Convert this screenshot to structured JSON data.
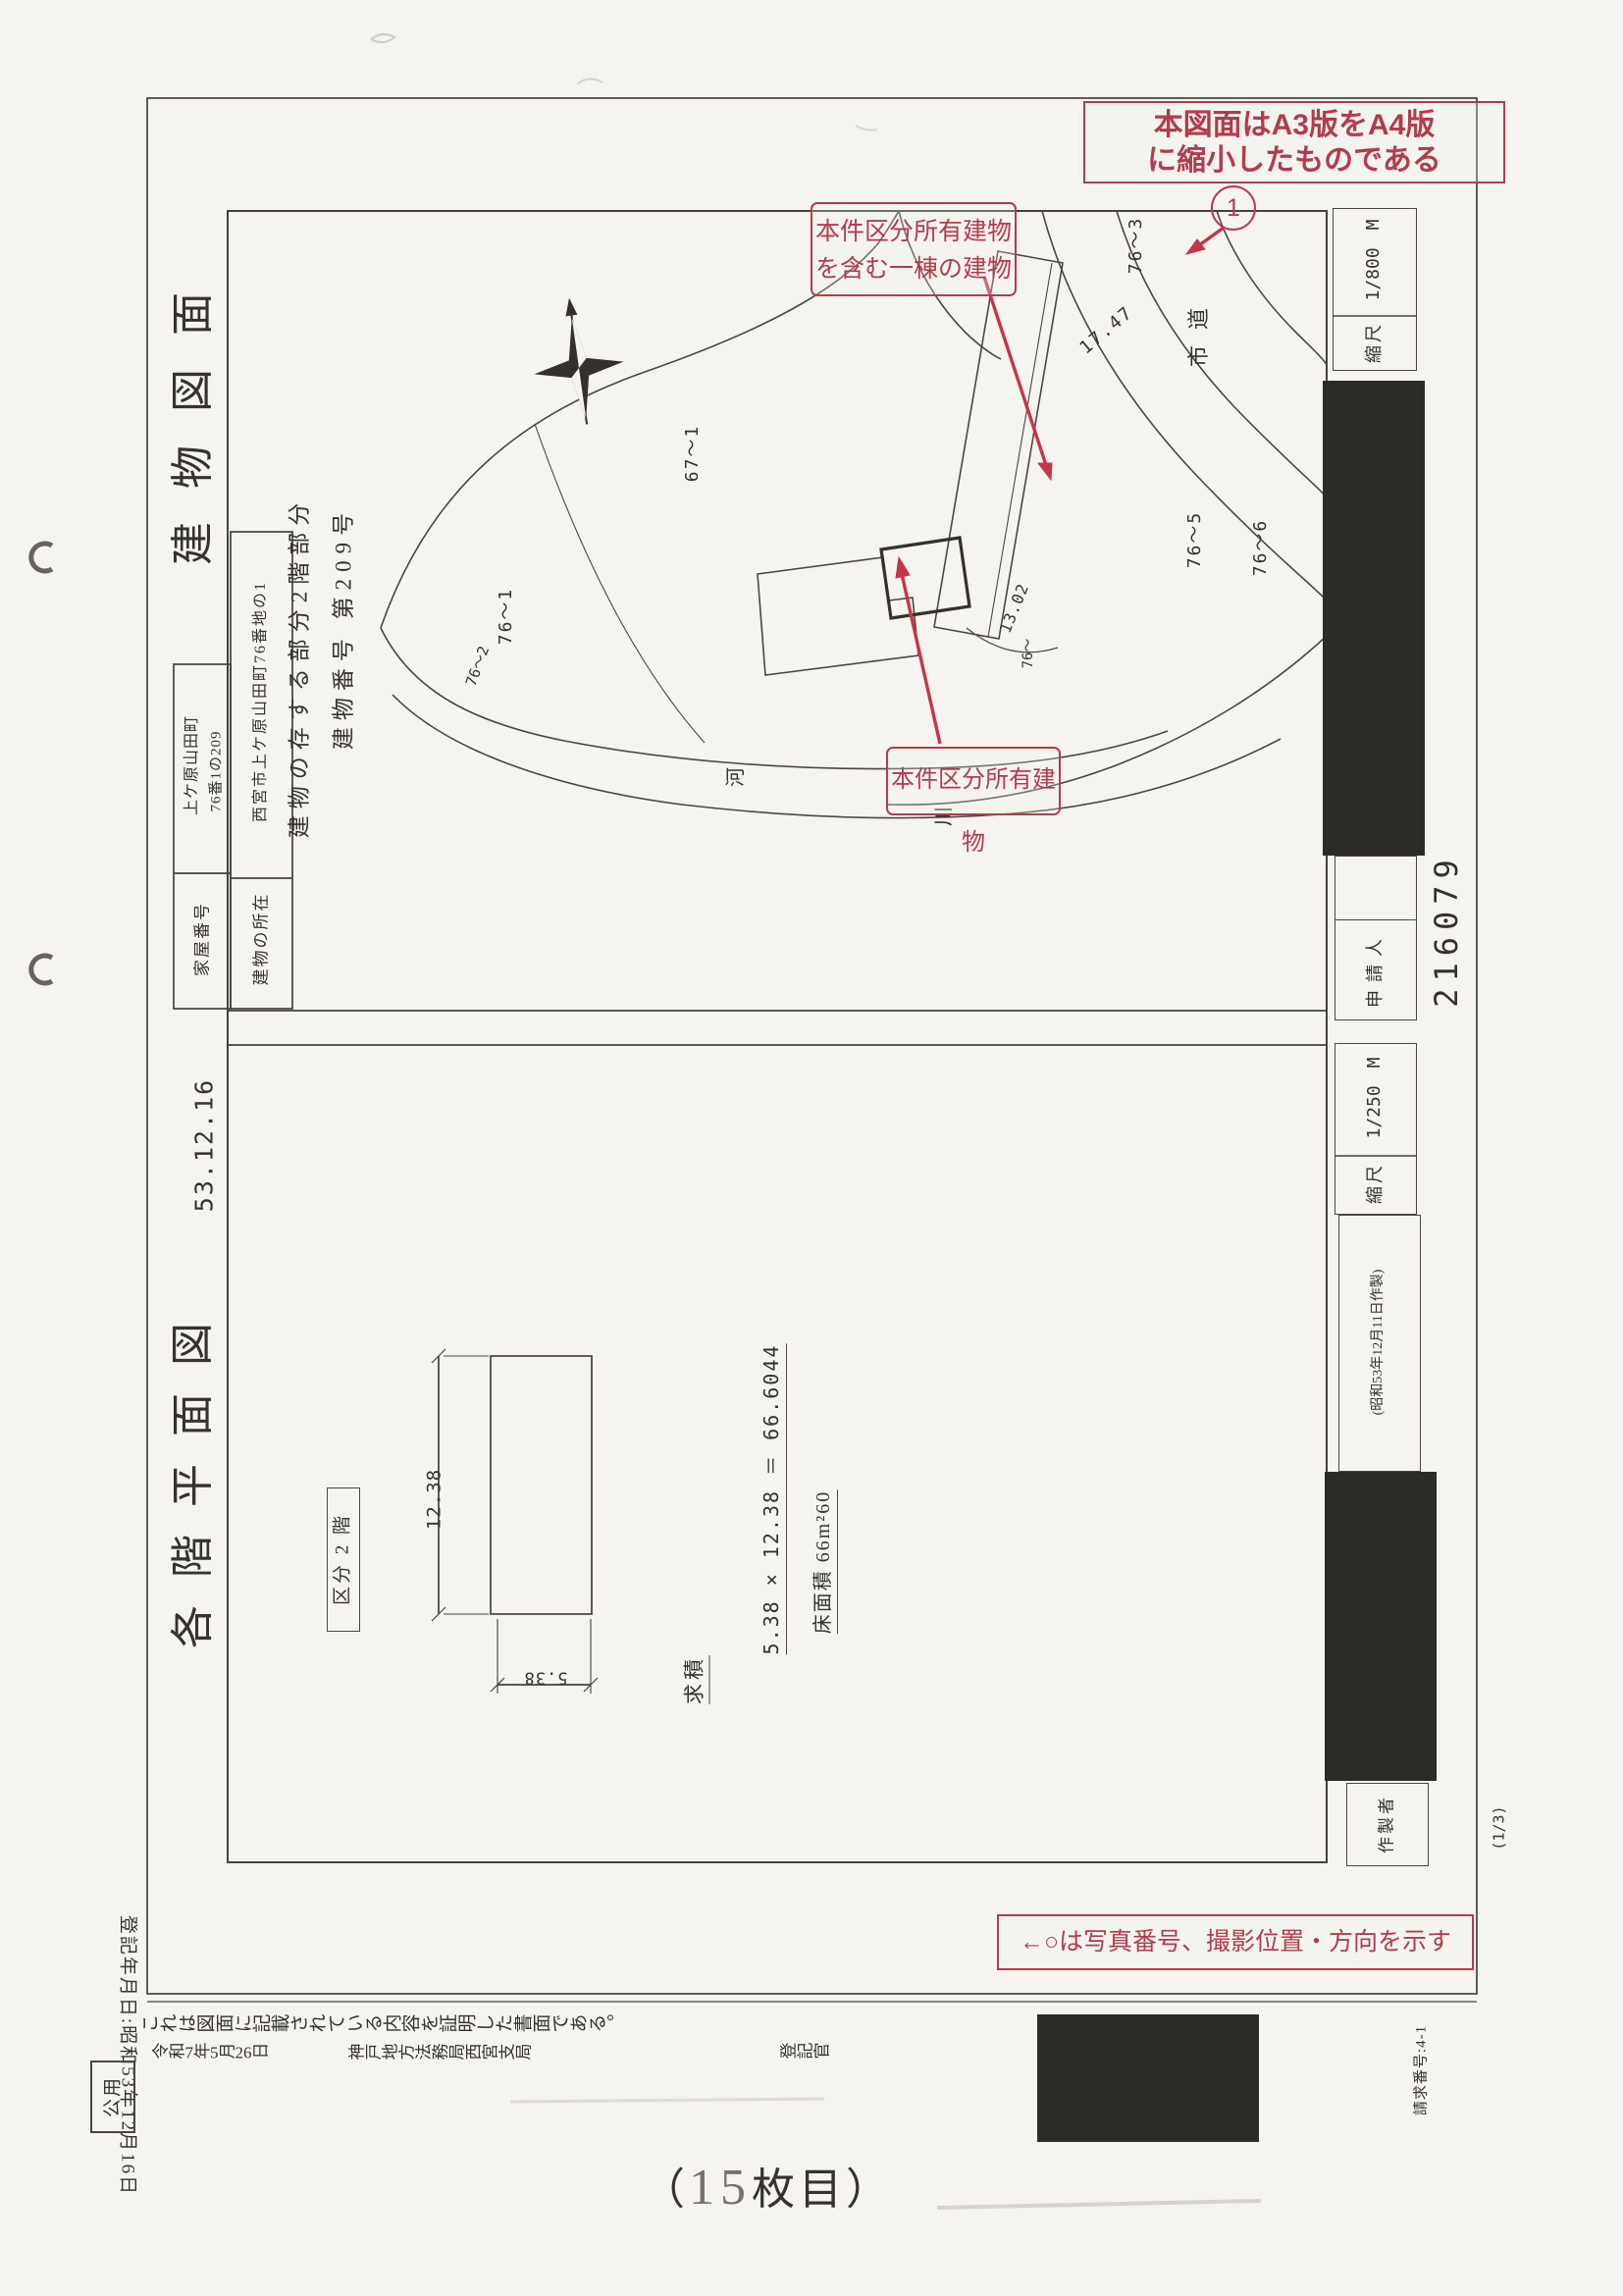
{
  "document": {
    "sheet_note_prefix": "（",
    "sheet_number": "15",
    "sheet_note_suffix": "枚目）",
    "page_fraction": "(1/3)",
    "request_number": "請求番号:4-1",
    "receipt_number": "216079",
    "public_use_stamp": "公用"
  },
  "red_annotations": {
    "reduction_note_line1": "本図面はA3版をA4版",
    "reduction_note_line2": "に縮小したものである",
    "photo_marker_number": "1",
    "containing_building_line1": "本件区分所有建物",
    "containing_building_line2": "を含む一棟の建物",
    "subject_building": "本件区分所有建物",
    "photo_legend": "←○は写真番号、撮影位置・方向を示す"
  },
  "building_diagram": {
    "title": "建物図面",
    "table": {
      "house_number_label": "家屋番号",
      "house_number_line1": "上ケ原山田町",
      "house_number_line2": "76番1の209",
      "location_label": "建物の所在",
      "location_value": "西宮市上ケ原山田町76番地の1"
    },
    "part_note": "建物の存する部分2階部分",
    "building_number": "建物番号 第209号",
    "scale_label": "縮尺",
    "scale_value": "1/800　M",
    "applicant_label": "申請人",
    "site_labels": {
      "parcel_67_1": "67〜1",
      "parcel_76_1": "76〜1",
      "parcel_76_2": "76〜2",
      "parcel_76_3": "76〜3",
      "parcel_76_5": "76〜5",
      "parcel_76_6": "76〜6",
      "parcel_76_part": "76〜",
      "road": "市道",
      "river_a": "河",
      "river_b": "川",
      "dim_top": "17.47",
      "dim_bottom": "13.02"
    }
  },
  "floor_plan": {
    "title": "各階平面図",
    "date": "53.12.16",
    "section_label": "区分 2 階",
    "dim_length": "12.38",
    "dim_width": "5.38",
    "calc_label": "求積",
    "calc_formula": "5.38 × 12.38 ＝ 66.6044",
    "floor_area": "床面積 66m²60",
    "scale_label": "縮尺",
    "scale_value": "1/250　M",
    "prepared_date": "(昭和53年12月11日作製)",
    "preparer_label": "作製者"
  },
  "certification": {
    "registration_date": "登記年月日:昭和53年12月16日",
    "statement": "これは図面に記載されている内容を証明した書面である。",
    "issue_date": "令和7年5月26日",
    "office": "神戸地方法務局西宮支局",
    "registrar": "登記官"
  }
}
